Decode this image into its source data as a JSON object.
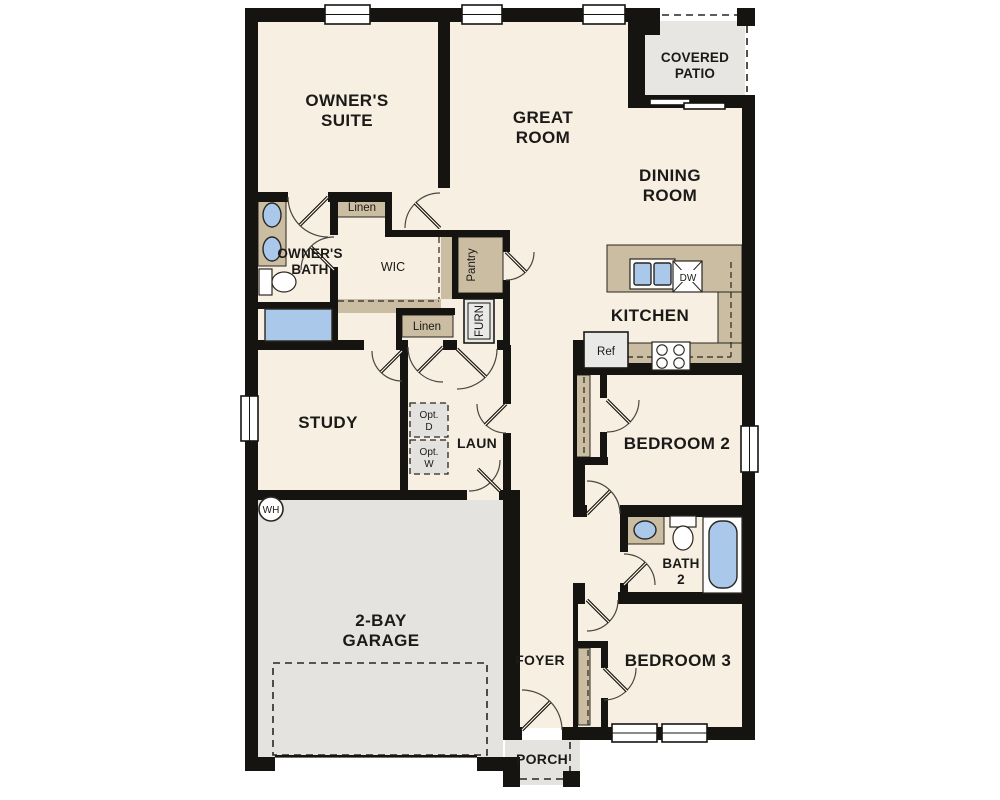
{
  "plan": {
    "type": "single-story residential floor plan"
  },
  "colors": {
    "floor": "#f7efe1",
    "wall": "#161411",
    "outdoor_gray": "#e4e3e0",
    "patio_gray": "#e7e6e3",
    "casework_tan": "#cabda1",
    "fixture_blue": "#aac8e9",
    "appliance_gray": "#e9e9e7"
  },
  "rooms": {
    "owners_suite": {
      "lines": [
        "OWNER'S",
        "SUITE"
      ]
    },
    "great_room": {
      "lines": [
        "GREAT",
        "ROOM"
      ]
    },
    "covered_patio": {
      "lines": [
        "COVERED",
        "PATIO"
      ]
    },
    "dining_room": {
      "lines": [
        "DINING",
        "ROOM"
      ]
    },
    "owners_bath": {
      "lines": [
        "OWNER'S",
        "BATH"
      ]
    },
    "wic": {
      "lines": [
        "WIC"
      ]
    },
    "kitchen": {
      "lines": [
        "KITCHEN"
      ]
    },
    "study": {
      "lines": [
        "STUDY"
      ]
    },
    "laundry": {
      "lines": [
        "LAUN"
      ]
    },
    "bedroom_2": {
      "lines": [
        "BEDROOM 2"
      ]
    },
    "bath_2": {
      "lines": [
        "BATH",
        "2"
      ]
    },
    "bedroom_3": {
      "lines": [
        "BEDROOM 3"
      ]
    },
    "foyer": {
      "lines": [
        "FOYER"
      ]
    },
    "garage": {
      "lines": [
        "2-BAY",
        "GARAGE"
      ]
    },
    "porch": {
      "lines": [
        "PORCH"
      ]
    }
  },
  "storage": {
    "linen_upper": "Linen",
    "linen_lower": "Linen",
    "pantry": "Pantry"
  },
  "equipment": {
    "furnace": "FURN",
    "water_heater": "WH",
    "dishwasher": "DW",
    "refrigerator": "Ref",
    "opt_dryer": {
      "lines": [
        "Opt.",
        "D"
      ]
    },
    "opt_washer": {
      "lines": [
        "Opt.",
        "W"
      ]
    }
  }
}
